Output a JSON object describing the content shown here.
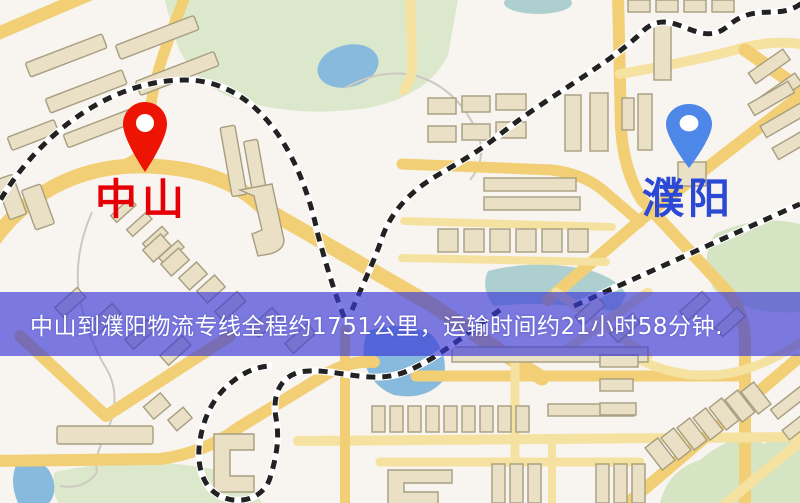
{
  "map": {
    "banner_text": "中山到濮阳物流专线全程约1751公里，运输时间约21小时58分钟.",
    "origin_label": "中山",
    "destination_label": "濮阳",
    "route": {
      "origin": "中山",
      "destination": "濮阳",
      "distance_km": 1751,
      "duration_hours": 21,
      "duration_minutes": 58
    },
    "icons": {
      "origin_pin": "red-map-pin",
      "destination_pin": "blue-map-pin"
    }
  },
  "colors": {
    "map_bg": "#f8f4ef",
    "park": "#dce8cc",
    "water": "#88bade",
    "road": "#f2cf74",
    "building": "#e9e0c6",
    "railway": "#222222",
    "banner_bg": "rgba(58,58,214,0.66)",
    "banner_text": "#ffffff",
    "origin_pin": "#ee1404",
    "destination_pin": "#4d87e8",
    "origin_label": "#e60005",
    "destination_label": "#2b49d4"
  }
}
